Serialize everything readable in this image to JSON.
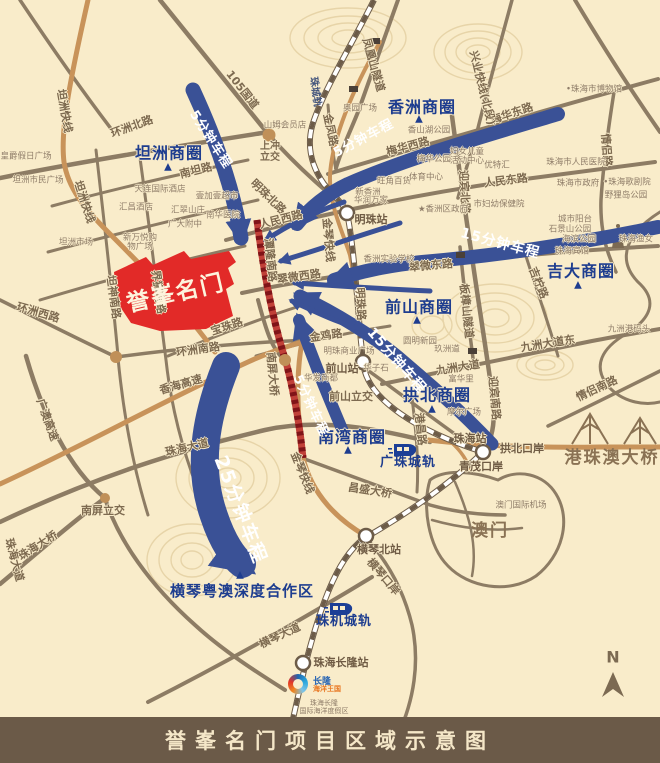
{
  "caption": "誉峯名门项目区域示意图",
  "project_name": "誉峯名门",
  "compass": "N",
  "logo": {
    "line1": "长隆",
    "line2": "海洋王国",
    "line3": "珠海长隆",
    "line4": "国际海洋度假区"
  },
  "colors": {
    "bg": "#f9ecca",
    "arrow_blue": "#3a5196",
    "district_blue": "#1e3d8f",
    "project_red": "#e22a28",
    "road_brown": "#8d7c64",
    "highway_orange": "#c8935a",
    "caption_bar": "#6b5a48"
  },
  "drive_times": [
    "5分钟车程",
    "15分钟车程",
    "25分钟车程"
  ],
  "train_icons": [
    {
      "x": 388,
      "y": 441
    },
    {
      "x": 324,
      "y": 600
    }
  ],
  "labels": [
    {
      "t": "坦洲快线",
      "x": 64,
      "y": 111,
      "r": 80,
      "c": "road"
    },
    {
      "t": "坦洲快线",
      "x": 84,
      "y": 202,
      "r": 72,
      "c": "road"
    },
    {
      "t": "105国道",
      "x": 242,
      "y": 90,
      "r": 52,
      "c": "road"
    },
    {
      "t": "环洲北路",
      "x": 132,
      "y": 127,
      "r": -20,
      "c": "road"
    },
    {
      "t": "南坦路",
      "x": 196,
      "y": 171,
      "r": -14,
      "c": "road"
    },
    {
      "t": "环洲西路",
      "x": 38,
      "y": 313,
      "r": 16,
      "c": "road"
    },
    {
      "t": "坦神南路",
      "x": 113,
      "y": 297,
      "r": 82,
      "c": "road"
    },
    {
      "t": "界狮南路",
      "x": 158,
      "y": 292,
      "r": 82,
      "c": "road"
    },
    {
      "t": "环洲南路",
      "x": 198,
      "y": 350,
      "r": -8,
      "c": "road"
    },
    {
      "t": "宝珠路",
      "x": 227,
      "y": 327,
      "r": -18,
      "c": "road"
    },
    {
      "t": "香海高速",
      "x": 181,
      "y": 385,
      "r": -16,
      "c": "road"
    },
    {
      "t": "珠海大道",
      "x": 187,
      "y": 448,
      "r": -13,
      "c": "road"
    },
    {
      "t": "广澳高速",
      "x": 47,
      "y": 420,
      "r": 70,
      "c": "road"
    },
    {
      "t": "南屏立交",
      "x": 103,
      "y": 511,
      "r": 0,
      "c": "road"
    },
    {
      "t": "珠海大桥",
      "x": 38,
      "y": 546,
      "r": -32,
      "c": "road"
    },
    {
      "t": "珠海大道",
      "x": 14,
      "y": 560,
      "r": 75,
      "c": "road"
    },
    {
      "t": "南屏大桥",
      "x": 272,
      "y": 374,
      "r": 85,
      "c": "road"
    },
    {
      "t": "金鸡路",
      "x": 326,
      "y": 336,
      "r": -8,
      "c": "road"
    },
    {
      "t": "金琴快线",
      "x": 328,
      "y": 240,
      "r": 85,
      "c": "road"
    },
    {
      "t": "金琴快线",
      "x": 302,
      "y": 473,
      "r": 68,
      "c": "road"
    },
    {
      "t": "明珠北路",
      "x": 268,
      "y": 197,
      "r": 44,
      "c": "road"
    },
    {
      "t": "人民西路",
      "x": 281,
      "y": 220,
      "r": -14,
      "c": "road"
    },
    {
      "t": "潭隆南路",
      "x": 270,
      "y": 260,
      "r": 84,
      "c": "road"
    },
    {
      "t": "翠微西路",
      "x": 299,
      "y": 277,
      "r": -8,
      "c": "road"
    },
    {
      "t": "翠微东路",
      "x": 431,
      "y": 266,
      "r": -5,
      "c": "road"
    },
    {
      "t": "明珠路",
      "x": 360,
      "y": 304,
      "r": 87,
      "c": "road"
    },
    {
      "t": "金凤路",
      "x": 330,
      "y": 130,
      "r": 78,
      "c": "road"
    },
    {
      "t": "梅华西路",
      "x": 408,
      "y": 147,
      "r": -15,
      "c": "road"
    },
    {
      "t": "梅华东路",
      "x": 512,
      "y": 114,
      "r": -19,
      "c": "road"
    },
    {
      "t": "人民东路",
      "x": 506,
      "y": 181,
      "r": -7,
      "c": "road"
    },
    {
      "t": "迎宾北路",
      "x": 464,
      "y": 192,
      "r": 87,
      "c": "road"
    },
    {
      "t": "迎宾南路",
      "x": 494,
      "y": 398,
      "r": 85,
      "c": "road"
    },
    {
      "t": "九洲大道",
      "x": 458,
      "y": 368,
      "r": -9,
      "c": "road"
    },
    {
      "t": "九洲大道东",
      "x": 548,
      "y": 344,
      "r": -9,
      "c": "road"
    },
    {
      "t": "情侣路",
      "x": 606,
      "y": 150,
      "r": 86,
      "c": "road"
    },
    {
      "t": "情侣南路",
      "x": 597,
      "y": 389,
      "r": -25,
      "c": "road"
    },
    {
      "t": "板樟山隧道",
      "x": 466,
      "y": 311,
      "r": 84,
      "c": "road"
    },
    {
      "t": "吉柠路",
      "x": 538,
      "y": 283,
      "r": 68,
      "c": "road"
    },
    {
      "t": "兴业快线(北段)",
      "x": 482,
      "y": 88,
      "r": 76,
      "c": "road"
    },
    {
      "t": "凤凰山隧道",
      "x": 373,
      "y": 65,
      "r": 74,
      "c": "road"
    },
    {
      "t": "港昌路",
      "x": 420,
      "y": 429,
      "r": 84,
      "c": "road"
    },
    {
      "t": "昌盛大桥",
      "x": 370,
      "y": 491,
      "r": 9,
      "c": "road"
    },
    {
      "t": "横琴大道",
      "x": 280,
      "y": 636,
      "r": -25,
      "c": "road"
    },
    {
      "t": "横琴口岸",
      "x": 383,
      "y": 577,
      "r": 50,
      "c": "road"
    },
    {
      "t": "前山立交",
      "x": 351,
      "y": 397,
      "r": 0,
      "c": "road"
    },
    {
      "t": "上冲立交",
      "x": 270,
      "y": 153,
      "r": 0,
      "c": "road2"
    },
    {
      "t": "珠城轨",
      "x": 314,
      "y": 92,
      "r": 82,
      "c": "transit-sm"
    },
    {
      "t": "皇爵假日广场",
      "x": 26,
      "y": 157,
      "r": 0,
      "c": "poi"
    },
    {
      "t": "坦洲市民广场",
      "x": 38,
      "y": 181,
      "r": 0,
      "c": "poi"
    },
    {
      "t": "坦洲市场",
      "x": 76,
      "y": 243,
      "r": 0,
      "c": "poi"
    },
    {
      "t": "天连国际酒店",
      "x": 160,
      "y": 190,
      "r": 0,
      "c": "poi"
    },
    {
      "t": "汇昌酒店",
      "x": 136,
      "y": 208,
      "r": 0,
      "c": "poi"
    },
    {
      "t": "壹加壹超市",
      "x": 217,
      "y": 197,
      "r": 0,
      "c": "poi"
    },
    {
      "t": "汇翠山庄",
      "x": 188,
      "y": 211,
      "r": 0,
      "c": "poi"
    },
    {
      "t": "南华医院",
      "x": 223,
      "y": 216,
      "r": 0,
      "c": "poi"
    },
    {
      "t": "广大附中",
      "x": 185,
      "y": 225,
      "r": 0,
      "c": "poi"
    },
    {
      "t": "新万悦购物广场",
      "x": 140,
      "y": 243,
      "r": 0,
      "c": "poi2"
    },
    {
      "t": "山姆会员店",
      "x": 285,
      "y": 126,
      "r": 0,
      "c": "poi"
    },
    {
      "t": "奥园广场",
      "x": 360,
      "y": 109,
      "r": 0,
      "c": "poi"
    },
    {
      "t": "香山湖公园",
      "x": 429,
      "y": 131,
      "r": 0,
      "c": "poi"
    },
    {
      "t": "梅华公园",
      "x": 434,
      "y": 160,
      "r": 0,
      "c": "poi"
    },
    {
      "t": "妇女儿童活动中心",
      "x": 467,
      "y": 157,
      "r": 0,
      "c": "poi2"
    },
    {
      "t": "优特汇",
      "x": 497,
      "y": 166,
      "r": 0,
      "c": "poi"
    },
    {
      "t": "旺角百货",
      "x": 394,
      "y": 182,
      "r": 0,
      "c": "poi"
    },
    {
      "t": "体育中心",
      "x": 426,
      "y": 178,
      "r": 0,
      "c": "poi"
    },
    {
      "t": "新香洲",
      "x": 368,
      "y": 193,
      "r": 0,
      "c": "poi"
    },
    {
      "t": "华润万家",
      "x": 371,
      "y": 201,
      "r": 0,
      "c": "poi"
    },
    {
      "t": "★香洲区政府",
      "x": 443,
      "y": 210,
      "r": 0,
      "c": "poi"
    },
    {
      "t": "市妇幼保健院",
      "x": 499,
      "y": 205,
      "r": 0,
      "c": "poi"
    },
    {
      "t": "•珠海市博物馆",
      "x": 594,
      "y": 90,
      "r": 0,
      "c": "poi"
    },
    {
      "t": "珠海市人民医院",
      "x": 576,
      "y": 163,
      "r": 0,
      "c": "poi"
    },
    {
      "t": "珠海市政府",
      "x": 578,
      "y": 184,
      "r": 0,
      "c": "poi"
    },
    {
      "t": "•珠海歌剧院",
      "x": 627,
      "y": 183,
      "r": 0,
      "c": "poi"
    },
    {
      "t": "野狸岛公园",
      "x": 626,
      "y": 196,
      "r": 0,
      "c": "poi"
    },
    {
      "t": "城市阳台",
      "x": 575,
      "y": 220,
      "r": 0,
      "c": "poi"
    },
    {
      "t": "石景山公园",
      "x": 570,
      "y": 230,
      "r": 0,
      "c": "poi"
    },
    {
      "t": "海滨公园",
      "x": 579,
      "y": 240,
      "r": 0,
      "c": "poi"
    },
    {
      "t": "珠海宾馆",
      "x": 572,
      "y": 252,
      "r": 0,
      "c": "poi"
    },
    {
      "t": "珠海渔女",
      "x": 636,
      "y": 240,
      "r": 0,
      "c": "poi"
    },
    {
      "t": "香洲实验学校",
      "x": 389,
      "y": 260,
      "r": 0,
      "c": "poi"
    },
    {
      "t": "圆明新园",
      "x": 420,
      "y": 342,
      "r": 0,
      "c": "poi"
    },
    {
      "t": "玖洲道",
      "x": 447,
      "y": 350,
      "r": 0,
      "c": "poi"
    },
    {
      "t": "富华里",
      "x": 461,
      "y": 380,
      "r": 0,
      "c": "poi"
    },
    {
      "t": "摩尔广场",
      "x": 464,
      "y": 413,
      "r": 0,
      "c": "poi"
    },
    {
      "t": "华发商都",
      "x": 321,
      "y": 379,
      "r": 0,
      "c": "poi"
    },
    {
      "t": "华子石",
      "x": 376,
      "y": 369,
      "r": 0,
      "c": "poi"
    },
    {
      "t": "明珠商业广场",
      "x": 349,
      "y": 352,
      "r": 0,
      "c": "poi"
    },
    {
      "t": "九洲港码头",
      "x": 629,
      "y": 330,
      "r": 0,
      "c": "poi"
    },
    {
      "t": "澳门国际机场",
      "x": 521,
      "y": 506,
      "r": 0,
      "c": "poi"
    },
    {
      "t": "明珠站",
      "x": 371,
      "y": 220,
      "r": 0,
      "c": "station"
    },
    {
      "t": "前山站",
      "x": 342,
      "y": 369,
      "r": 0,
      "c": "station"
    },
    {
      "t": "珠海站",
      "x": 470,
      "y": 439,
      "r": 0,
      "c": "station"
    },
    {
      "t": "拱北口岸",
      "x": 522,
      "y": 449,
      "r": 0,
      "c": "station"
    },
    {
      "t": "青茂口岸",
      "x": 481,
      "y": 467,
      "r": 0,
      "c": "station"
    },
    {
      "t": "横琴北站",
      "x": 379,
      "y": 550,
      "r": 0,
      "c": "station"
    },
    {
      "t": "珠海长隆站",
      "x": 341,
      "y": 663,
      "r": 0,
      "c": "station"
    },
    {
      "t": "广珠城轨",
      "x": 408,
      "y": 463,
      "r": 0,
      "c": "transit"
    },
    {
      "t": "珠机城轨",
      "x": 344,
      "y": 622,
      "r": 0,
      "c": "transit"
    },
    {
      "t": "坦洲商圈",
      "x": 169,
      "y": 153,
      "r": 0,
      "c": "biz"
    },
    {
      "t": "▲",
      "x": 168,
      "y": 168,
      "r": 0,
      "c": "tri"
    },
    {
      "t": "香洲商圈",
      "x": 422,
      "y": 107,
      "r": 0,
      "c": "biz"
    },
    {
      "t": "▲",
      "x": 419,
      "y": 120,
      "r": 0,
      "c": "tri"
    },
    {
      "t": "前山商圈",
      "x": 419,
      "y": 307,
      "r": 0,
      "c": "biz"
    },
    {
      "t": "▲",
      "x": 417,
      "y": 321,
      "r": 0,
      "c": "tri"
    },
    {
      "t": "吉大商圈",
      "x": 581,
      "y": 271,
      "r": 0,
      "c": "biz"
    },
    {
      "t": "▲",
      "x": 578,
      "y": 286,
      "r": 0,
      "c": "tri"
    },
    {
      "t": "拱北商圈",
      "x": 437,
      "y": 395,
      "r": 0,
      "c": "biz"
    },
    {
      "t": "▲",
      "x": 432,
      "y": 410,
      "r": 0,
      "c": "tri"
    },
    {
      "t": "南湾商圈",
      "x": 352,
      "y": 437,
      "r": 0,
      "c": "biz"
    },
    {
      "t": "▲",
      "x": 348,
      "y": 451,
      "r": 0,
      "c": "tri"
    },
    {
      "t": "横琴粤澳深度合作区",
      "x": 242,
      "y": 591,
      "r": 0,
      "c": "biz-sm"
    },
    {
      "t": "▲",
      "x": 240,
      "y": 576,
      "r": 0,
      "c": "tri"
    },
    {
      "t": "5分钟车程",
      "x": 210,
      "y": 140,
      "r": 57,
      "c": "drive"
    },
    {
      "t": "5分钟车程",
      "x": 364,
      "y": 139,
      "r": -28,
      "c": "drive"
    },
    {
      "t": "5分钟车程",
      "x": 310,
      "y": 406,
      "r": 65,
      "c": "drive"
    },
    {
      "t": "15分钟车程",
      "x": 500,
      "y": 244,
      "r": 15,
      "c": "drive-md"
    },
    {
      "t": "15分钟车程",
      "x": 396,
      "y": 361,
      "r": 49,
      "c": "drive-md"
    },
    {
      "t": "25分钟车程",
      "x": 240,
      "y": 510,
      "r": 69,
      "c": "drive-lg"
    },
    {
      "t": "港珠澳大桥",
      "x": 612,
      "y": 458,
      "r": 0,
      "c": "area-lg"
    },
    {
      "t": "澳门",
      "x": 490,
      "y": 531,
      "r": 0,
      "c": "area-lg"
    },
    {
      "t": "誉峯名门",
      "x": 176,
      "y": 294,
      "r": -13,
      "c": "project"
    },
    {
      "t": "N",
      "x": 613,
      "y": 657,
      "r": 0,
      "c": "compass"
    }
  ]
}
